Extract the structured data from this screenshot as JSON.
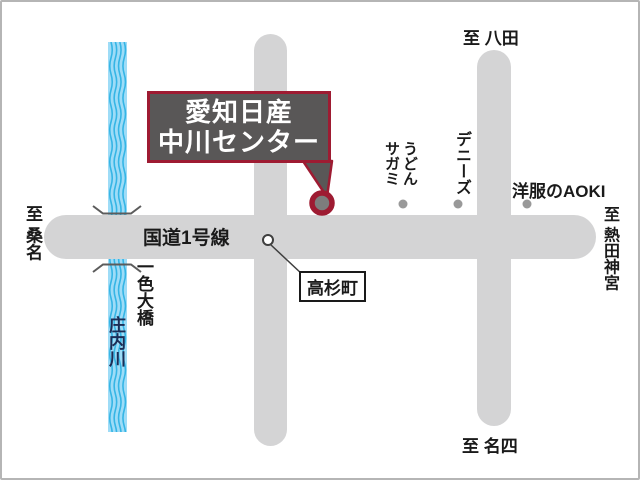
{
  "colors": {
    "road": "#d4d4d5",
    "river_fill": "#9edcf7",
    "river_wave": "#35b5e5",
    "accent_red": "#9e1b32",
    "callout_bg": "#595757",
    "callout_text": "#ffffff",
    "landmark_dot": "#999999",
    "river_text": "#1c2d56"
  },
  "callout": {
    "line1": "愛知日産",
    "line2": "中川センター"
  },
  "road_label": "国道1号線",
  "intersection": {
    "label": "高杉町"
  },
  "river": {
    "name": "庄内川"
  },
  "bridge": {
    "name": "一色大橋"
  },
  "directions": {
    "top": "至 八田",
    "left": "至 桑名",
    "right": "至 熱田神宮",
    "bottom": "至 名四"
  },
  "landmarks": [
    {
      "label": "うどん\nサガミ"
    },
    {
      "label": "デニーズ"
    },
    {
      "label": "洋服のAOKI"
    }
  ]
}
